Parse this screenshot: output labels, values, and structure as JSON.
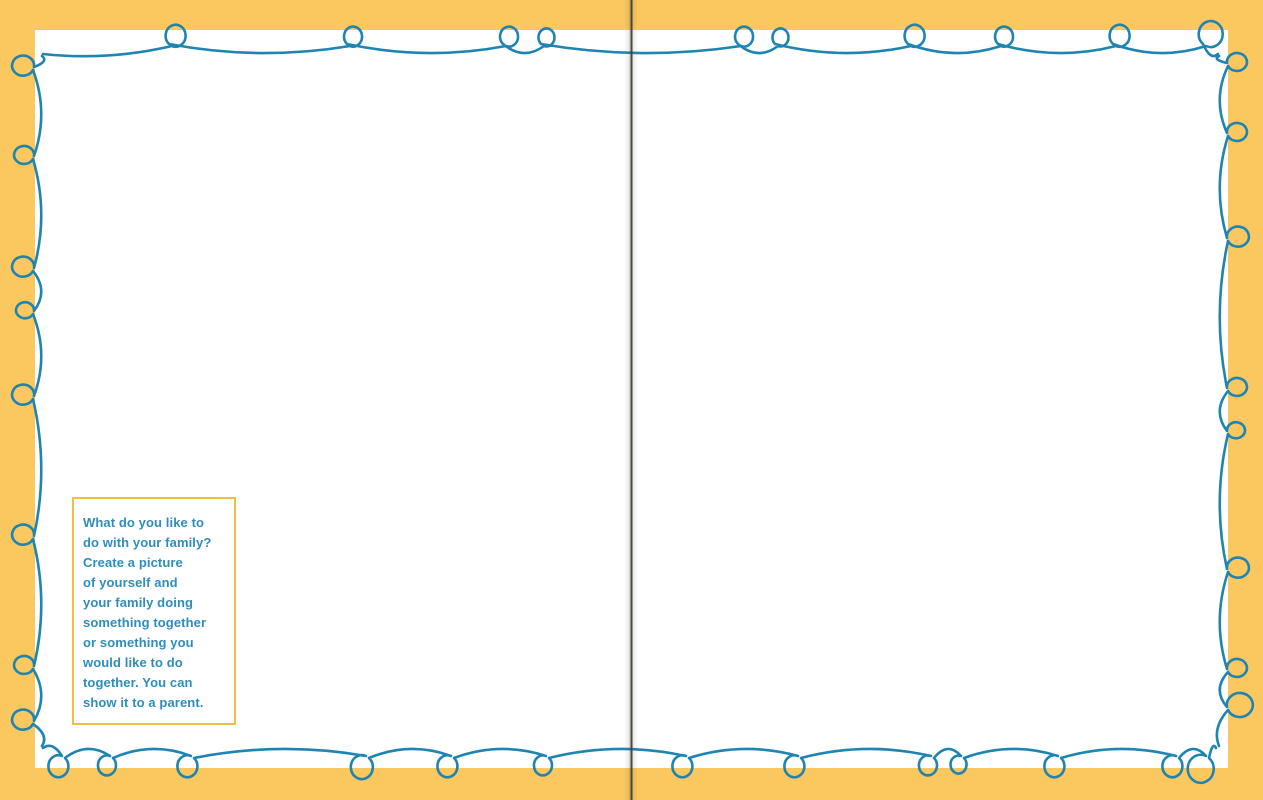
{
  "prompt_box": {
    "lines": [
      "What do you like to",
      "do with your family?",
      "Create a picture",
      "of yourself and",
      "your family doing",
      "something together",
      "or something you",
      "would like to do",
      "together. You can",
      "show it to a parent."
    ],
    "text": "What do you like to do with your family? Create a picture of yourself and your family doing something together or something you would like to do together. You can show it to a parent."
  },
  "colors": {
    "background": "#FBC75F",
    "page": "#FFFFFF",
    "loop_line": "#1E84B2",
    "prompt_text": "#2D8EBD",
    "prompt_border": "#ECC044",
    "gutter_line": "#3F3E37"
  }
}
